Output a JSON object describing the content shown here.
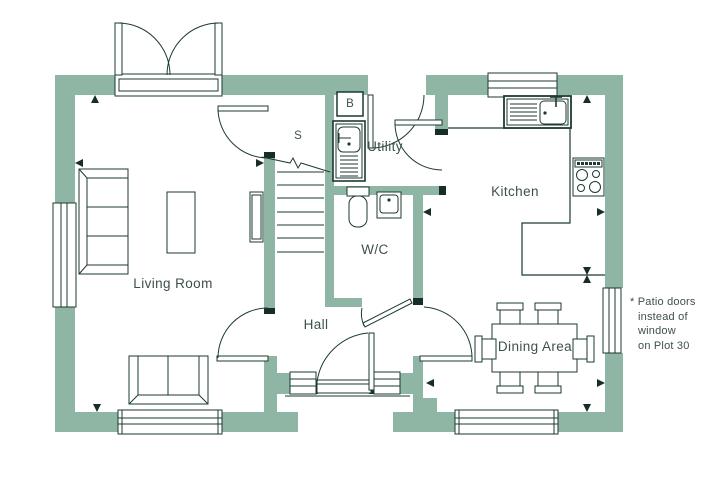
{
  "floorplan": {
    "title": "Ground floor plan",
    "rooms": {
      "living_room": "Living Room",
      "hall": "Hall",
      "wc": "W/C",
      "utility": "Utility",
      "kitchen": "Kitchen",
      "dining_area": "Dining Area"
    },
    "markers": {
      "store": "S",
      "boiler": "B"
    },
    "note": {
      "line1": "* Patio doors",
      "line2": "instead of",
      "line3": "window",
      "line4": "on Plot 30"
    },
    "colors": {
      "wall": "#8fb5a4",
      "line": "#1c3a32",
      "cap": "#152e27",
      "text": "#3d5049",
      "bg": "#ffffff"
    }
  }
}
